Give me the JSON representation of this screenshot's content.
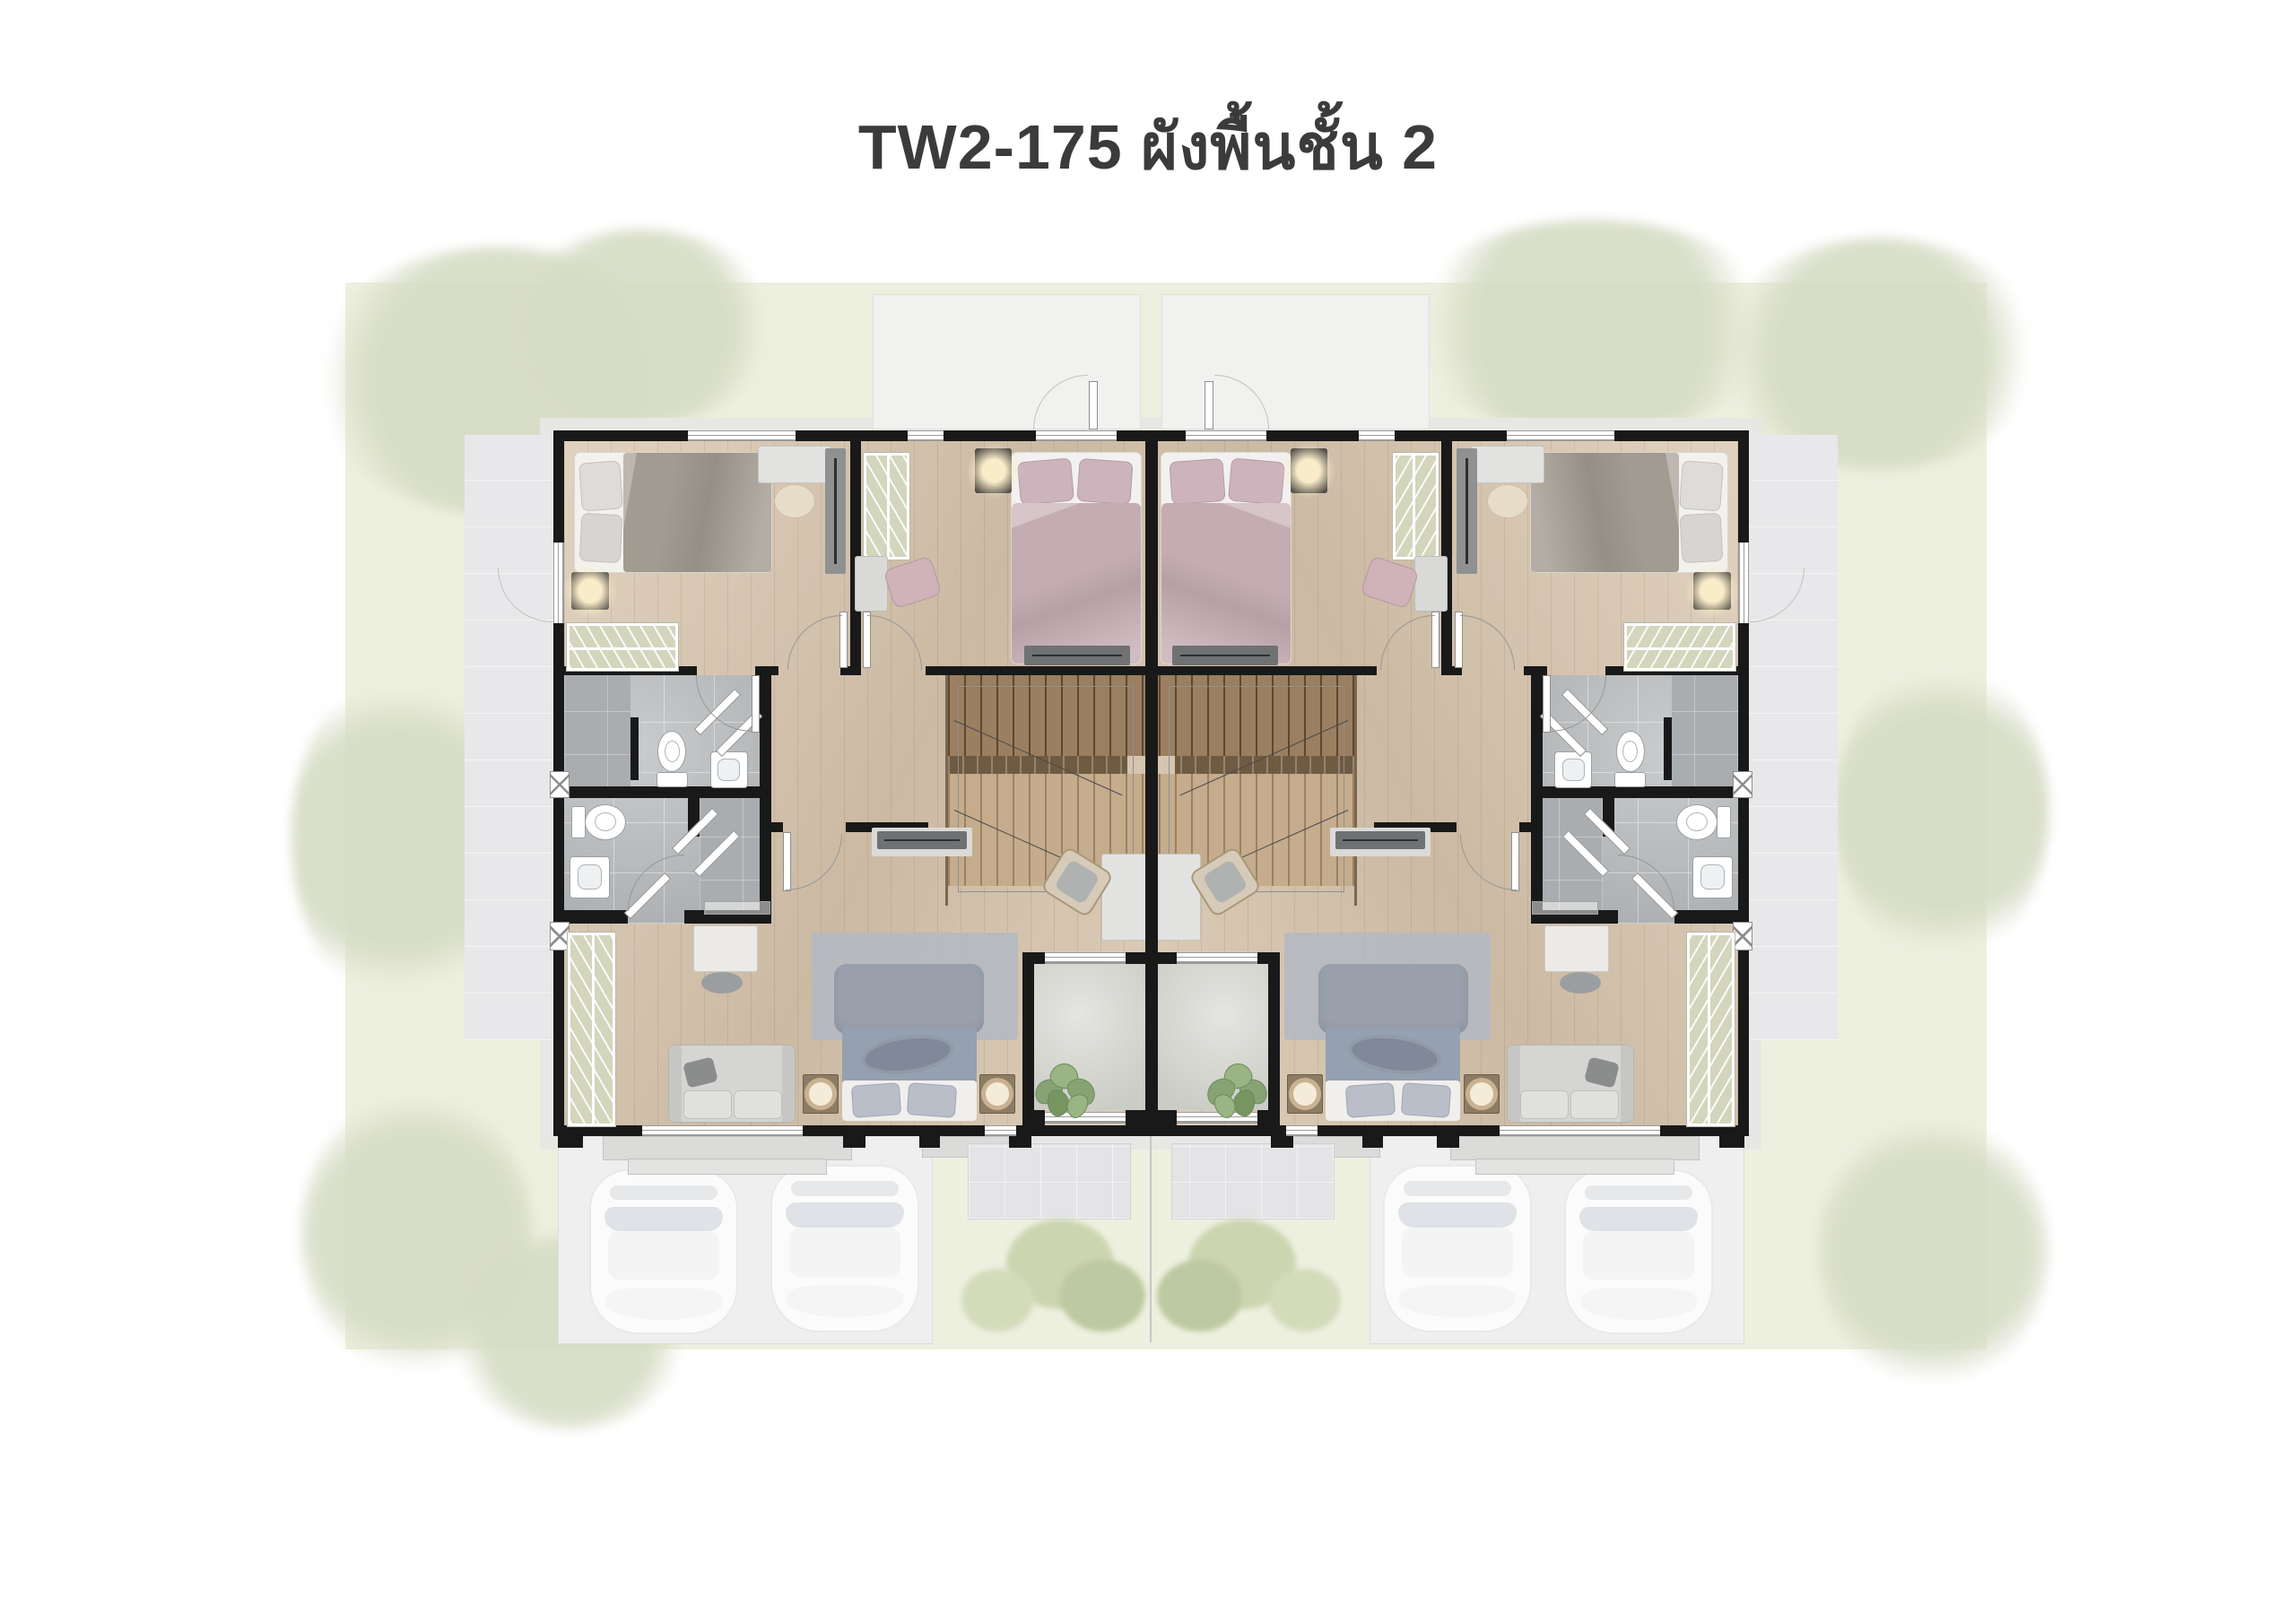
{
  "page": {
    "title": "TW2-175  ผังพื้นชั้น 2"
  },
  "plan": {
    "model_code": "TW2-175",
    "floor_label_thai": "ผังพื้นชั้น 2",
    "units_visible": 2,
    "cars_visible": 4,
    "balconies_visible": 2,
    "staircases_visible": 2
  },
  "palette": {
    "wall": "#191919",
    "wood": "#d8c5ad",
    "tile": "#b7babc",
    "tile_dark": "#a9adb0",
    "yard": "#edf0df",
    "patio": "#e8e8ea",
    "balcony": "#d6d7d0",
    "sage": "#d3d5bc",
    "stair_dark": "#9a7f61",
    "stair_light": "#c4ac8c",
    "bed_gray": "#a29b91",
    "bed_blue": "#95a0b0",
    "bed_pink": "#c4acb2",
    "glow": "#f6e4b5",
    "car": "#fbfbfb",
    "title_color": "#3b3b3d"
  }
}
